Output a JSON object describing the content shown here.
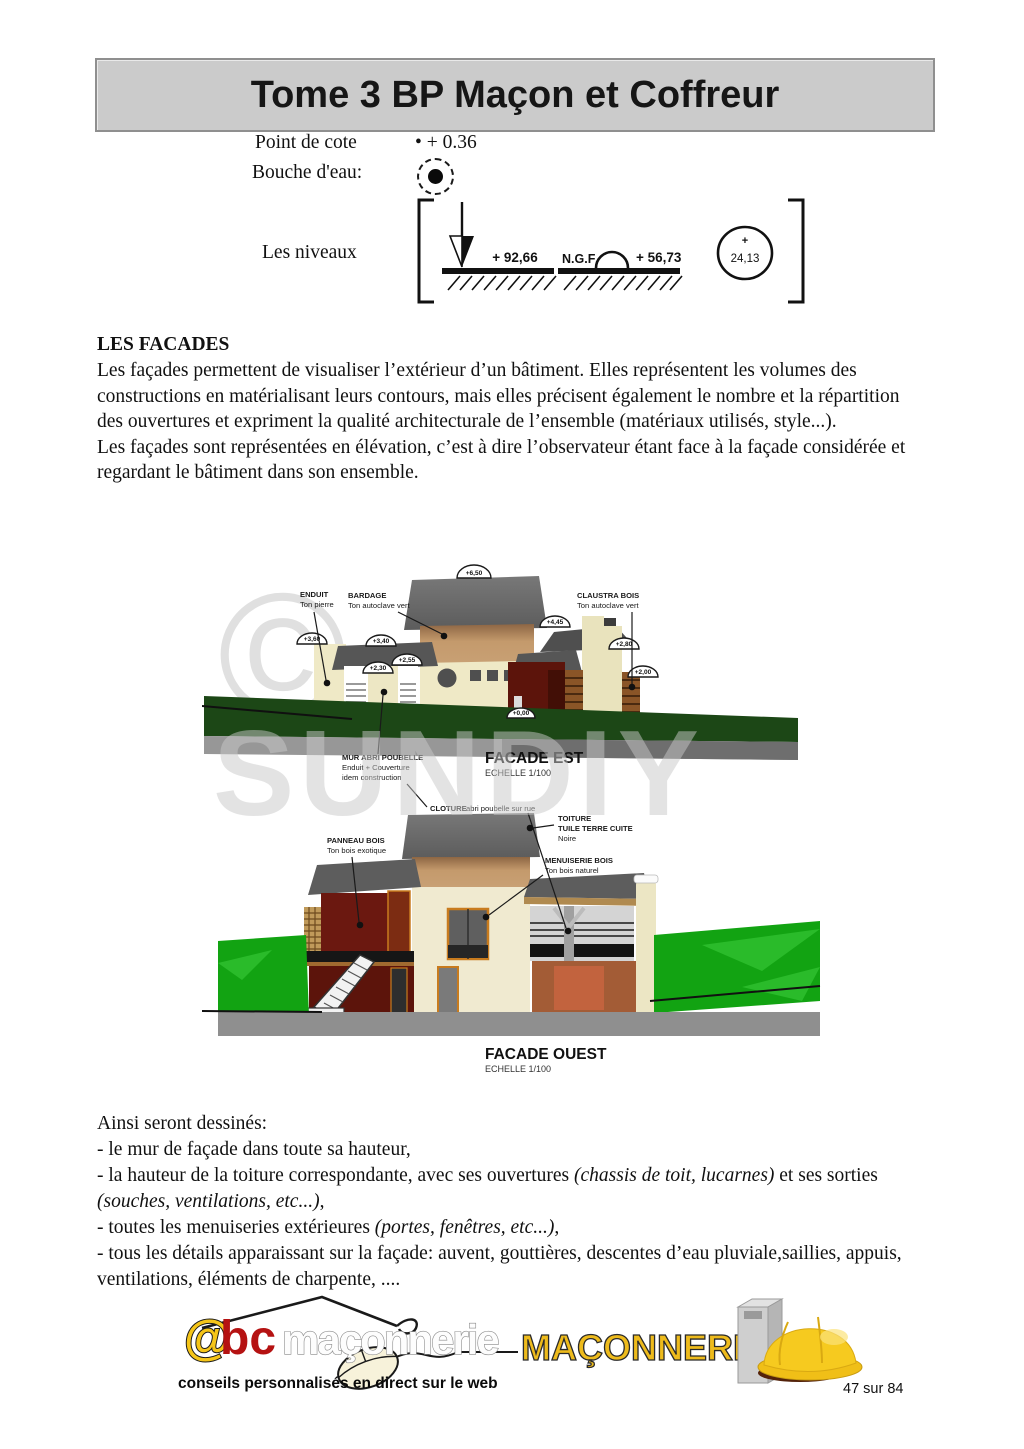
{
  "banner": {
    "title": "Tome 3 BP Maçon et Coffreur"
  },
  "legend": {
    "point_de_cote_label": "Point de cote",
    "point_de_cote_value": "• + 0.36",
    "bouche_eau_label": "Bouche d'eau:",
    "niveaux_label": "Les niveaux",
    "niveau_fleche": "+ 92,66",
    "niveau_ngf_prefix": "N.G.F",
    "niveau_ngf_value": "+ 56,73",
    "niveau_cercle_plus": "+",
    "niveau_cercle_value": "24,13"
  },
  "facades": {
    "heading": "LES FACADES",
    "para1": "Les façades permettent de visualiser l’extérieur d’un bâtiment. Elles représentent les volumes des constructions en matérialisant leurs contours, mais elles précisent également le nombre et la répartition des ouvertures et expriment la qualité architecturale de l’ensemble (matériaux utilisés, style...).",
    "para2": "Les façades sont représentées en élévation, c’est à dire l’observateur étant face à la façade considérée et regardant le bâtiment dans son ensemble."
  },
  "watermark": {
    "copyright": "©",
    "brand": "SUNDIY"
  },
  "facade_est": {
    "title": "FACADE EST",
    "scale": "ECHELLE 1/100",
    "markers": {
      "top": "+6,50",
      "right": "+4,45",
      "left": "+3,60",
      "mid": "+3,40",
      "a255": "+2,55",
      "a230": "+2,30",
      "a280": "+2,80",
      "a200": "+2,00",
      "zero": "+0,00"
    },
    "labels": {
      "enduit_l1": "ENDUIT",
      "enduit_l2": "Ton pierre",
      "bardage_l1": "BARDAGE",
      "bardage_l2": "Ton autoclave vert",
      "claustra_l1": "CLAUSTRA BOIS",
      "claustra_l2": "Ton autoclave vert",
      "mur_l1": "MUR ABRI POUBELLE",
      "mur_l2": "Enduit + Couverture",
      "mur_l3": "idem construction"
    }
  },
  "facade_ouest": {
    "title": "FACADE OUEST",
    "scale": "ECHELLE 1/100",
    "labels": {
      "cloture_bold": "CLOTURE",
      "cloture_rest": " abri poubelle sur rue",
      "panneau_l1": "PANNEAU BOIS",
      "panneau_l2": "Ton bois exotique",
      "toiture_l1": "TOITURE",
      "toiture_l2": "TUILE TERRE CUITE",
      "toiture_l3": "Noire",
      "menuiserie_l1": "MENUISERIE BOIS",
      "menuiserie_l2": "Ton bois naturel"
    }
  },
  "ainsi": {
    "intro": "Ainsi seront dessinés:",
    "items": [
      {
        "segments": [
          {
            "text": "- le mur de façade dans toute sa hauteur,",
            "italic": false
          }
        ]
      },
      {
        "segments": [
          {
            "text": "- la hauteur de la toiture correspondante, avec ses ouvertures ",
            "italic": false
          },
          {
            "text": "(chassis de toit, lucarnes)",
            "italic": true
          },
          {
            "text": " et ses sorties ",
            "italic": false
          },
          {
            "text": "(souches, ventilations, etc...)",
            "italic": true
          },
          {
            "text": ",",
            "italic": false
          }
        ]
      },
      {
        "segments": [
          {
            "text": "- toutes les menuiseries extérieures ",
            "italic": false
          },
          {
            "text": "(portes, fenêtres, etc...)",
            "italic": true
          },
          {
            "text": ",",
            "italic": false
          }
        ]
      },
      {
        "segments": [
          {
            "text": "- tous les détails apparaissant sur la façade: auvent, gouttières, descentes d’eau pluviale,saillies, appuis, ventilations, éléments de charpente, ....",
            "italic": false
          }
        ]
      }
    ]
  },
  "footer": {
    "logo_at": "@",
    "logo_bc": "bc",
    "logo_name": "maçonnerie",
    "logo_tagline": "conseils personnalisés en direct sur le web",
    "badge": "MAÇONNERIE",
    "page_number": "47 sur 84"
  },
  "colors": {
    "banner_bg": "#cbcbcb",
    "roof_gray": "#666666",
    "bardage_tan": "#c49a6c",
    "wall_cream": "#efe9c6",
    "wood_red": "#68170d",
    "lawn_dark": "#1c4716",
    "lawn_bright": "#12a312",
    "base_gray": "#8f8f8f",
    "claustra_brown": "#8a5527",
    "frame_orange": "#c87b1e",
    "logo_yellow": "#f2c41d",
    "logo_red": "#b51212",
    "badge_yellow": "#eebb1c"
  }
}
